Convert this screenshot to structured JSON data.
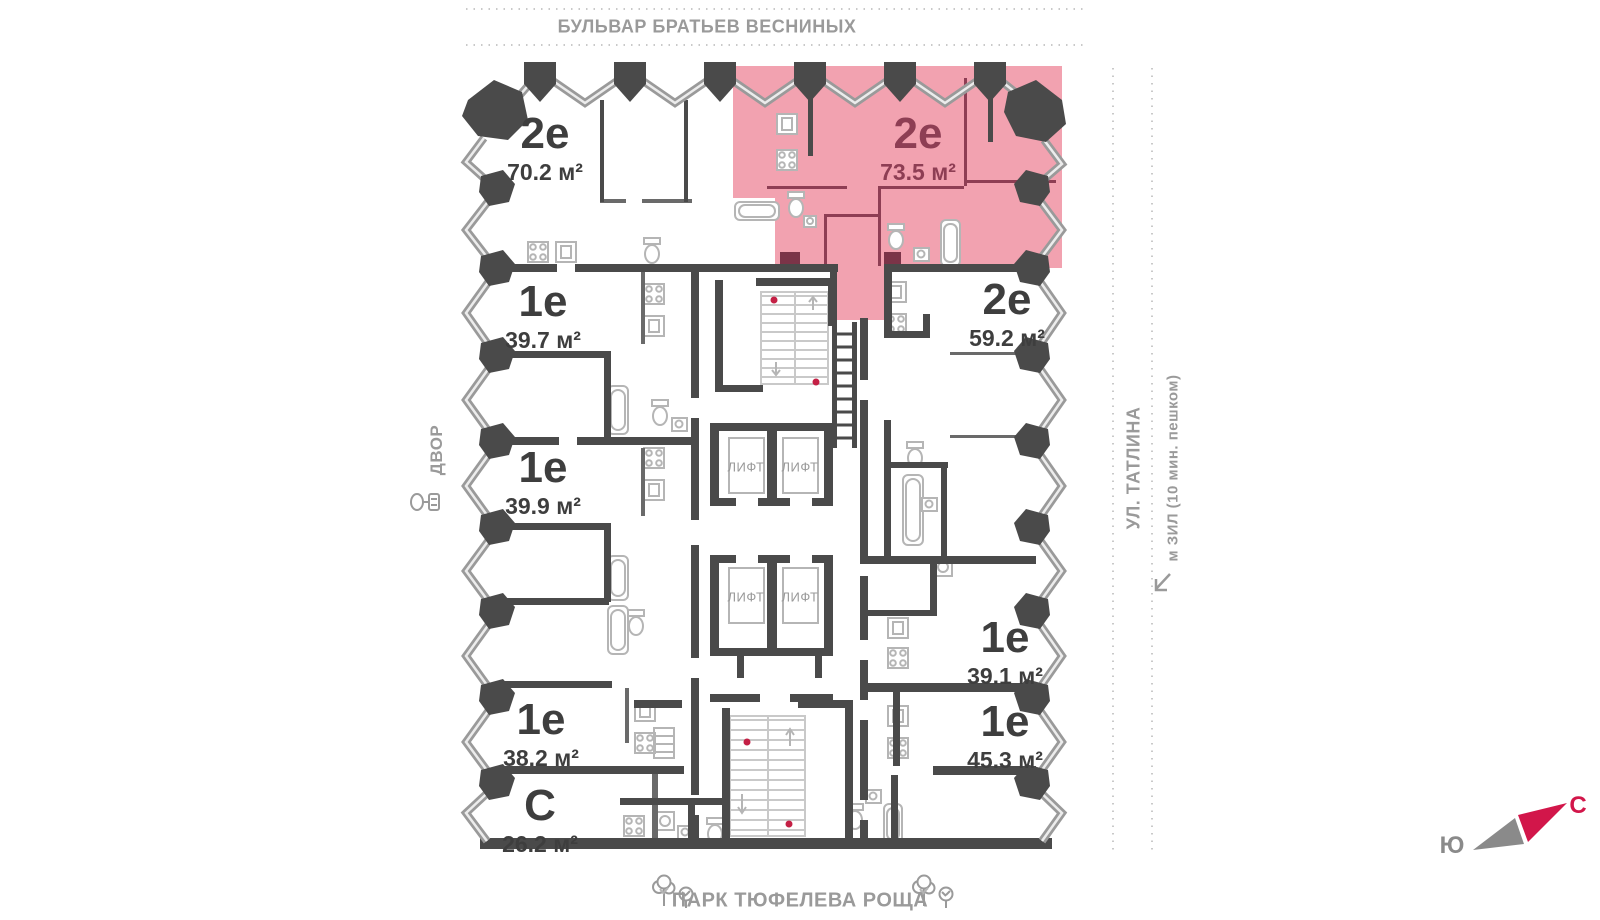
{
  "streets": {
    "top": "БУЛЬВАР БРАТЬЕВ ВЕСНИНЫХ",
    "right_primary": "УЛ. ТАТЛИНА",
    "right_secondary": "м ЗИЛ (10 мин. пешком)",
    "left": "ДВОР",
    "bottom": "ПАРК ТЮФЕЛЕВА РОЩА"
  },
  "compass": {
    "north": "С",
    "south": "Ю"
  },
  "elevator_label": "ЛИФТ",
  "apartments": [
    {
      "id": "apt-2e-70-2",
      "type": "2е",
      "area": "70.2 м²",
      "highlighted": false
    },
    {
      "id": "apt-2e-73-5",
      "type": "2е",
      "area": "73.5 м²",
      "highlighted": true
    },
    {
      "id": "apt-1e-39-7",
      "type": "1е",
      "area": "39.7 м²",
      "highlighted": false
    },
    {
      "id": "apt-2e-59-2",
      "type": "2е",
      "area": "59.2 м²",
      "highlighted": false
    },
    {
      "id": "apt-1e-39-9",
      "type": "1е",
      "area": "39.9 м²",
      "highlighted": false
    },
    {
      "id": "apt-1e-39-1",
      "type": "1е",
      "area": "39.1 м²",
      "highlighted": false
    },
    {
      "id": "apt-1e-38-2",
      "type": "1е",
      "area": "38.2 м²",
      "highlighted": false
    },
    {
      "id": "apt-1e-45-3",
      "type": "1е",
      "area": "45.3 м²",
      "highlighted": false
    },
    {
      "id": "apt-s-26-2",
      "type": "С",
      "area": "26.2 м²",
      "highlighted": false
    }
  ],
  "colors": {
    "wall": "#4A4A4A",
    "muted_text": "#9A9A9A",
    "highlight_fill": "#F2A2B0",
    "highlight_text": "#8E3E54",
    "unit_text": "#3E3E3E",
    "fixture": "#B5B5B5",
    "stair": "#C9C9C9",
    "stair_dot": "#C42045",
    "compass_north": "#D2164A",
    "compass_south": "#8A8A8A"
  }
}
